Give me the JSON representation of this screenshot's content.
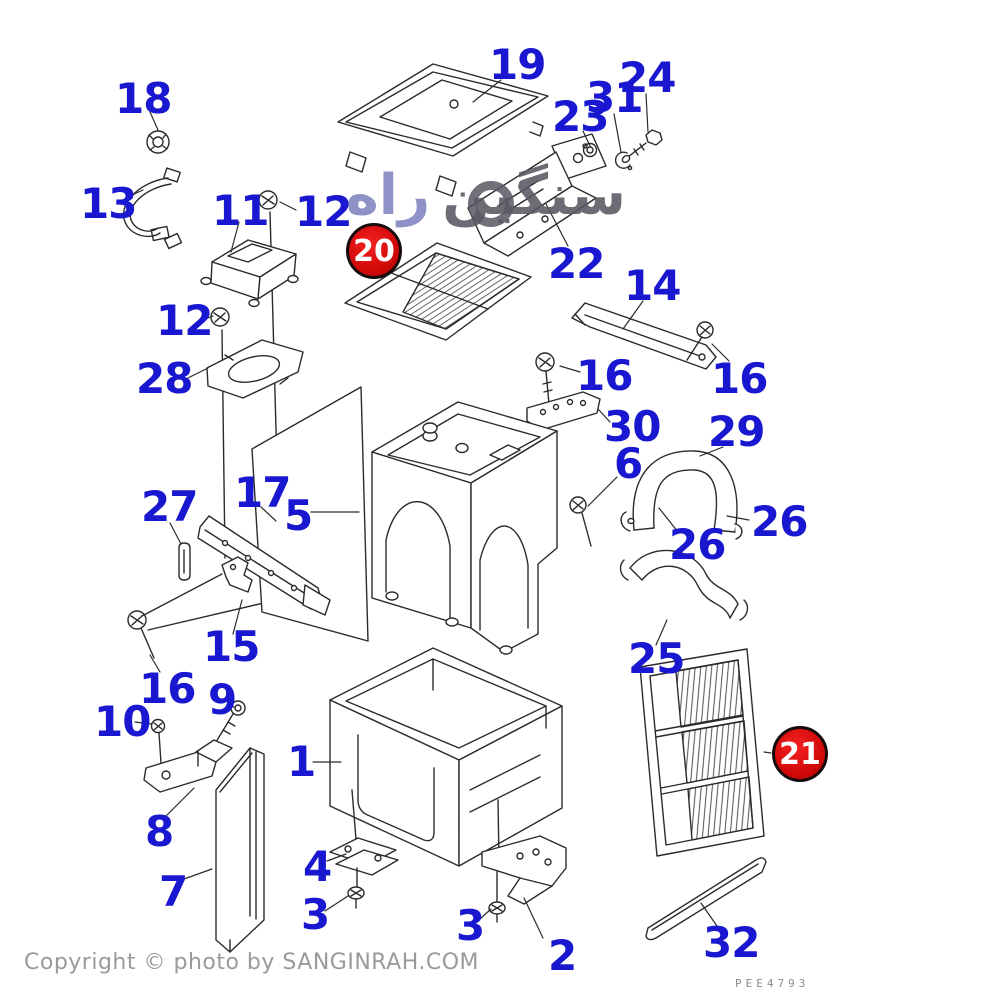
{
  "page": {
    "background": "#ffffff",
    "line_color": "#2b2b2b"
  },
  "label_style": {
    "color": "#1A17D0",
    "badge_color": "#D20909",
    "badge_text_color": "#ffffff"
  },
  "watermark": {
    "word_right": "سنگین",
    "word_left": "راه"
  },
  "footer": {
    "copyright": "Copyright © photo by SANGINRAH.COM",
    "drawing_code": "PEE4793"
  },
  "badges": [
    {
      "text": "20"
    },
    {
      "text": "21"
    }
  ],
  "labels": [
    {
      "text": "18"
    },
    {
      "text": "13"
    },
    {
      "text": "11"
    },
    {
      "text": "12"
    },
    {
      "text": "19"
    },
    {
      "text": "23"
    },
    {
      "text": "31"
    },
    {
      "text": "24"
    },
    {
      "text": "22"
    },
    {
      "text": "14"
    },
    {
      "text": "12"
    },
    {
      "text": "28"
    },
    {
      "text": "16"
    },
    {
      "text": "16"
    },
    {
      "text": "30"
    },
    {
      "text": "29"
    },
    {
      "text": "6"
    },
    {
      "text": "27"
    },
    {
      "text": "17"
    },
    {
      "text": "5"
    },
    {
      "text": "26"
    },
    {
      "text": "26"
    },
    {
      "text": "15"
    },
    {
      "text": "16"
    },
    {
      "text": "9"
    },
    {
      "text": "10"
    },
    {
      "text": "25"
    },
    {
      "text": "1"
    },
    {
      "text": "8"
    },
    {
      "text": "7"
    },
    {
      "text": "4"
    },
    {
      "text": "3"
    },
    {
      "text": "3"
    },
    {
      "text": "2"
    },
    {
      "text": "32"
    }
  ]
}
